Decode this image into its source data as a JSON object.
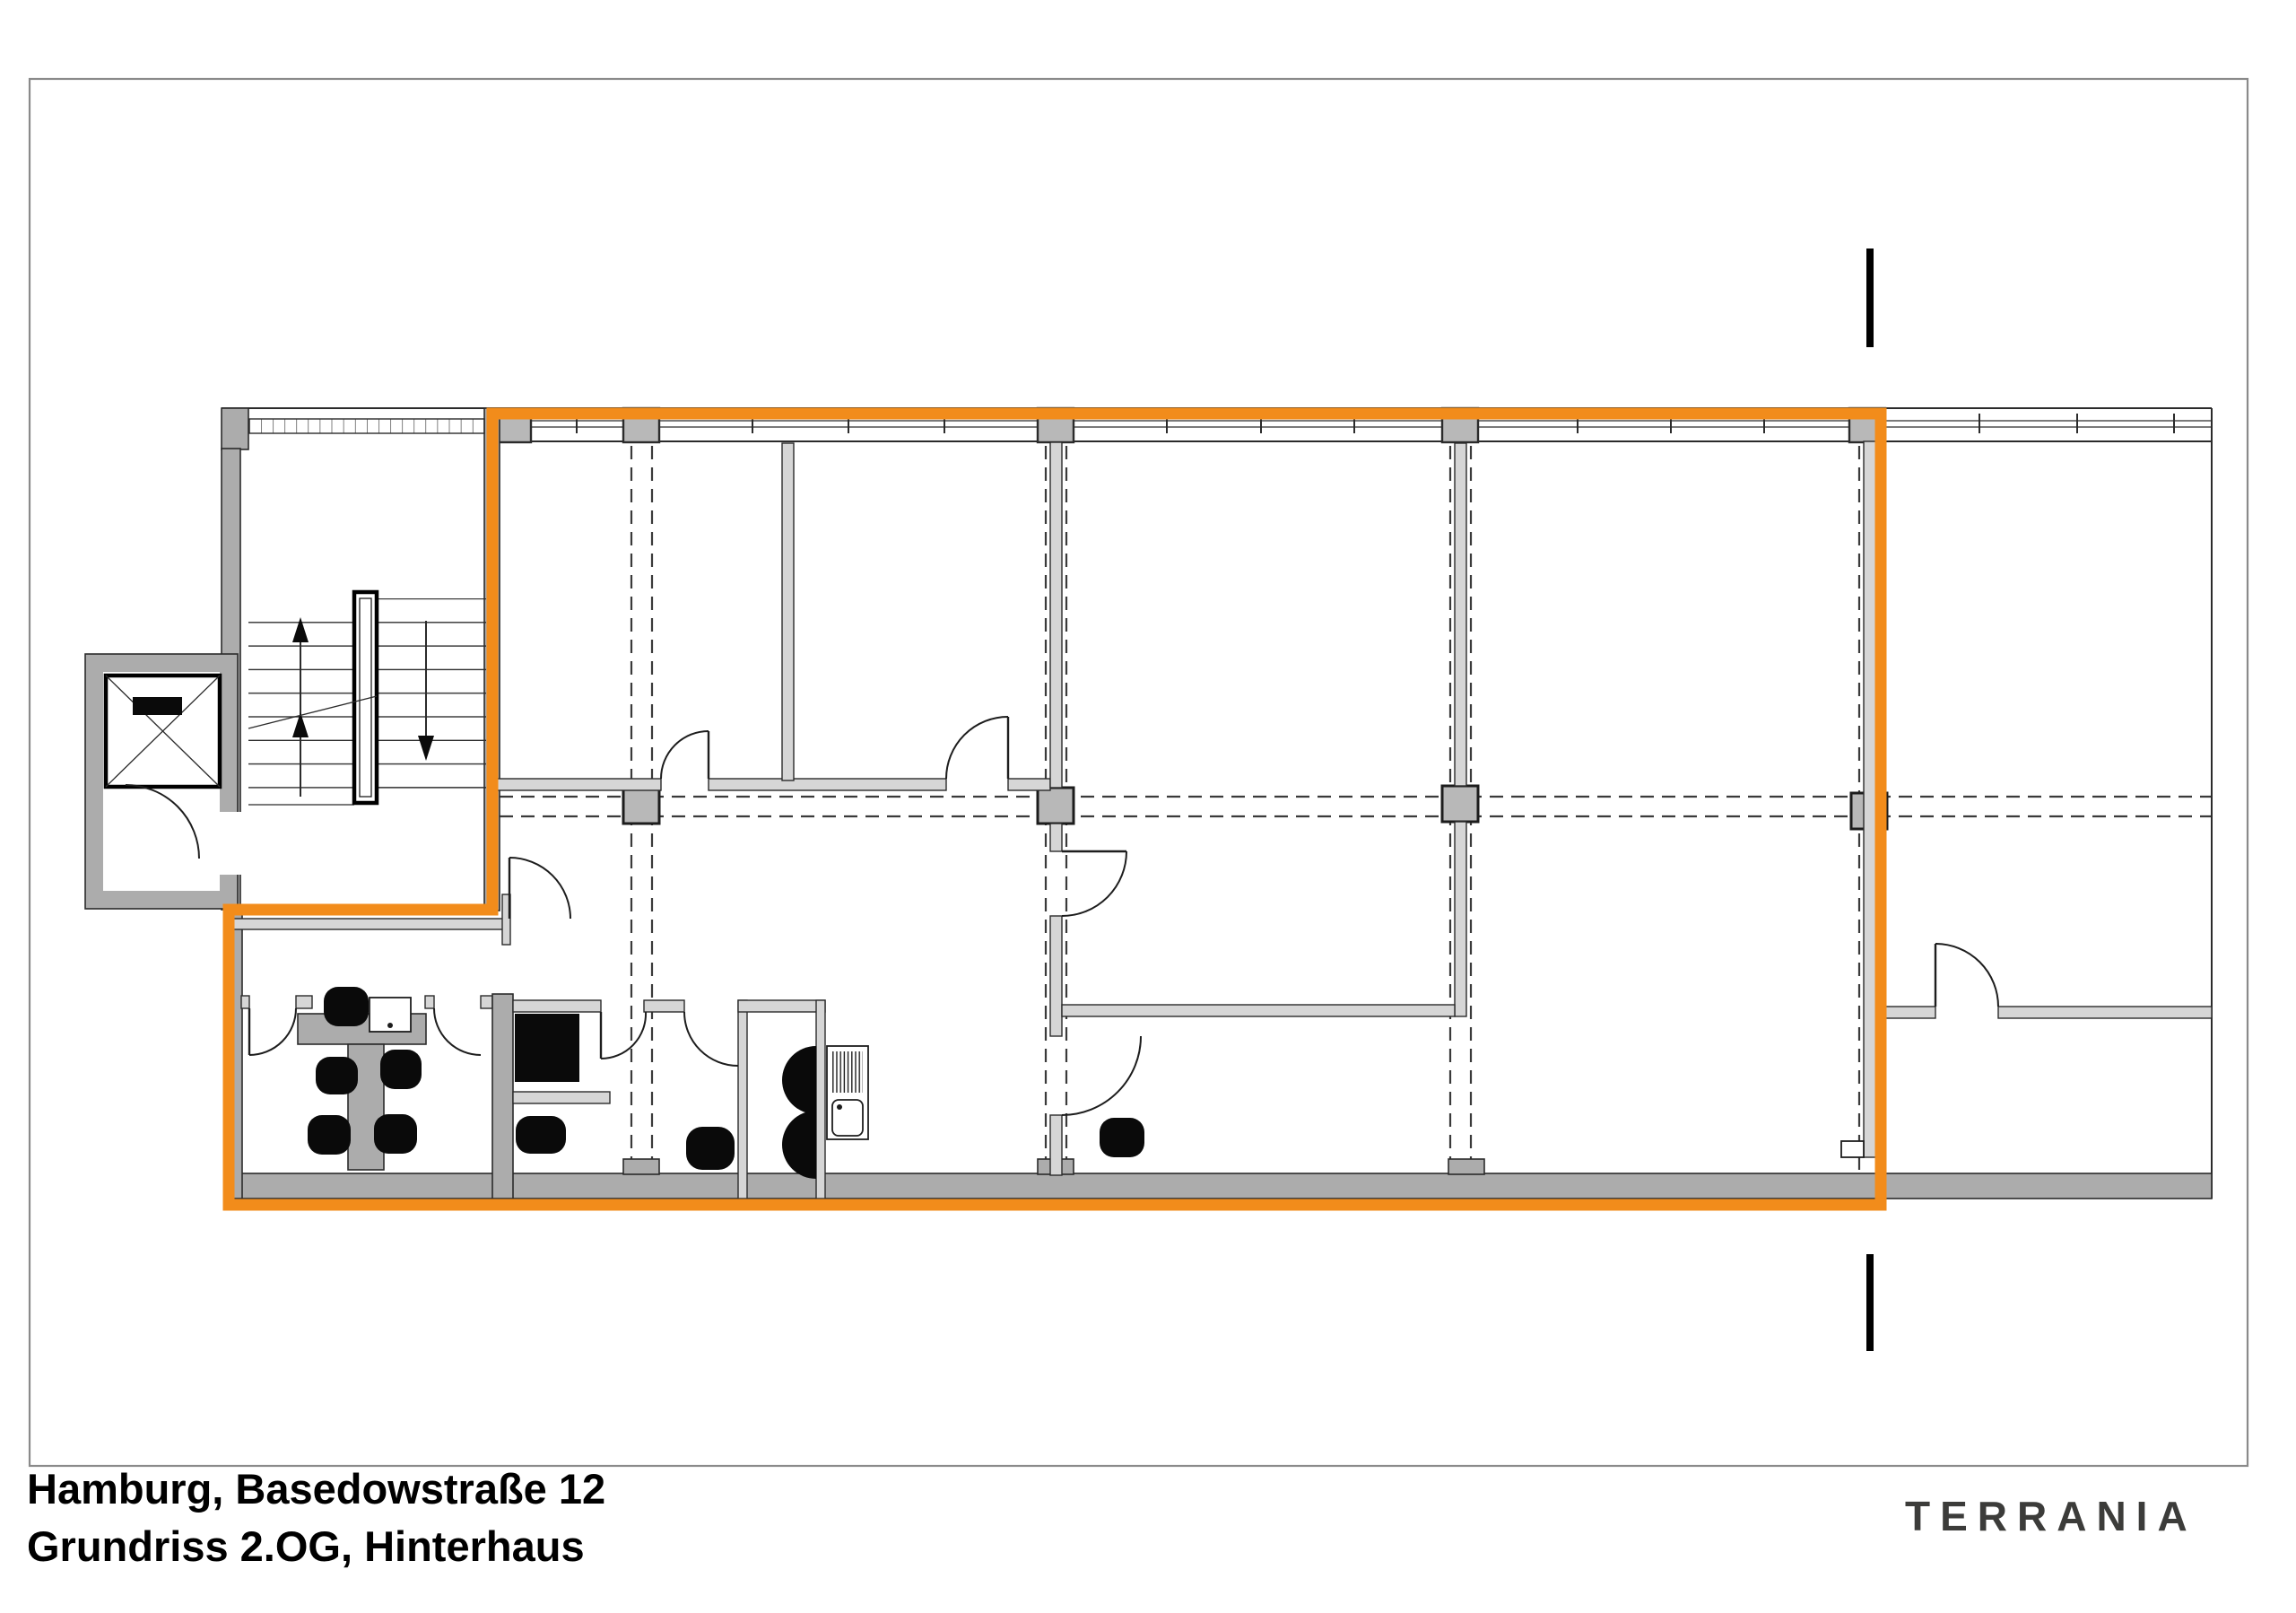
{
  "title_block": {
    "line1": "Hamburg, Basedowstraße 12",
    "line2": "Grundriss 2.OG, Hinterhaus"
  },
  "logo": {
    "text": "TERRANIA"
  },
  "colors": {
    "highlight": "#F28C1B",
    "wall": "#ACACAC",
    "partition": "#D6D6D6",
    "column": "#B8B8B8",
    "line": "#2B2B2B",
    "page_border": "#8A8A8A",
    "logo_text": "#3C3C3A",
    "furniture": "#0A0A0A"
  },
  "icons": {
    "elevator": "elevator-shaft-cross-icon",
    "stairs_up": "arrow-up-icon",
    "stairs_down": "arrow-down-icon",
    "section_mark": "section-cut-bar"
  }
}
